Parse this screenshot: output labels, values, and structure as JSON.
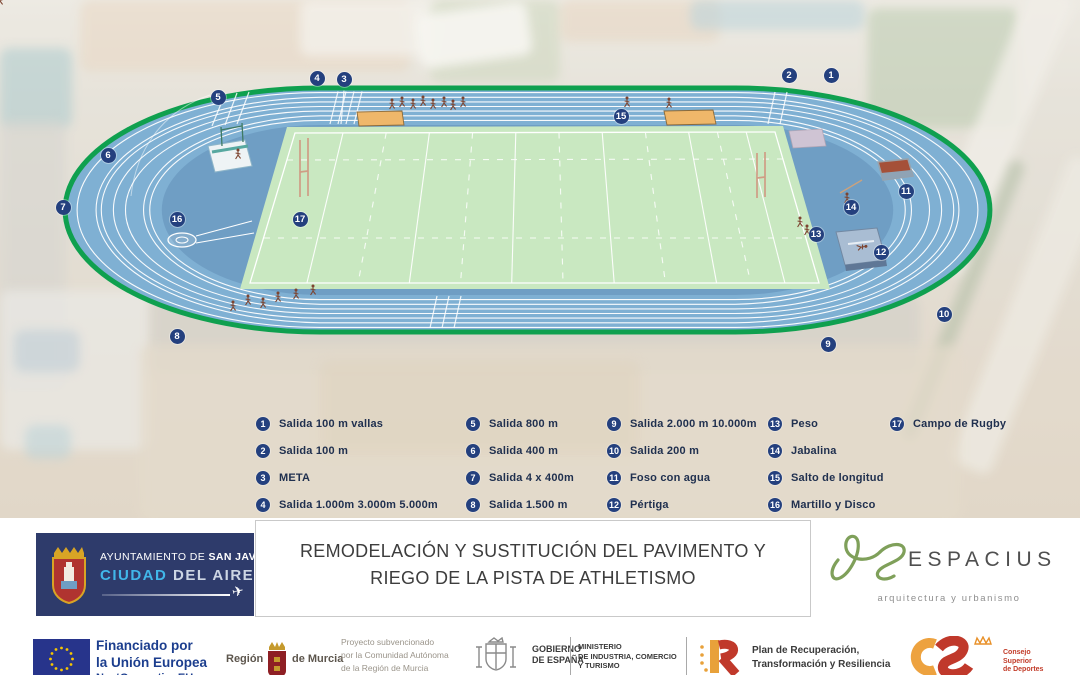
{
  "colors": {
    "marker_navy": "#24407e",
    "track_blue": "#7fb0d3",
    "infield_blue": "#6f9ec4",
    "field_green": "#c9e8c1",
    "edge_green": "#0fa04f",
    "eu_blue": "#27348b",
    "accent_cyan": "#41b7e9"
  },
  "markers": [
    {
      "n": "1",
      "x": 831,
      "y": 75
    },
    {
      "n": "2",
      "x": 789,
      "y": 75
    },
    {
      "n": "3",
      "x": 344,
      "y": 79
    },
    {
      "n": "4",
      "x": 317,
      "y": 78
    },
    {
      "n": "5",
      "x": 218,
      "y": 97
    },
    {
      "n": "6",
      "x": 108,
      "y": 155
    },
    {
      "n": "7",
      "x": 63,
      "y": 207
    },
    {
      "n": "8",
      "x": 177,
      "y": 336
    },
    {
      "n": "9",
      "x": 828,
      "y": 344
    },
    {
      "n": "10",
      "x": 944,
      "y": 314
    },
    {
      "n": "11",
      "x": 906,
      "y": 191
    },
    {
      "n": "12",
      "x": 881,
      "y": 252
    },
    {
      "n": "13",
      "x": 816,
      "y": 234
    },
    {
      "n": "14",
      "x": 851,
      "y": 207
    },
    {
      "n": "15",
      "x": 621,
      "y": 116
    },
    {
      "n": "16",
      "x": 177,
      "y": 219
    },
    {
      "n": "17",
      "x": 300,
      "y": 219
    }
  ],
  "legend": {
    "row_top": 417,
    "row_step": 27,
    "columns": [
      {
        "x": 256,
        "items": [
          {
            "n": "1",
            "label": "Salida 100 m vallas"
          },
          {
            "n": "2",
            "label": "Salida 100 m"
          },
          {
            "n": "3",
            "label": "META"
          },
          {
            "n": "4",
            "label": "Salida 1.000m 3.000m 5.000m"
          }
        ]
      },
      {
        "x": 466,
        "items": [
          {
            "n": "5",
            "label": "Salida 800 m"
          },
          {
            "n": "6",
            "label": "Salida 400 m"
          },
          {
            "n": "7",
            "label": "Salida 4 x 400m"
          },
          {
            "n": "8",
            "label": "Salida 1.500 m"
          }
        ]
      },
      {
        "x": 607,
        "items": [
          {
            "n": "9",
            "label": "Salida 2.000 m 10.000m"
          },
          {
            "n": "10",
            "label": "Salida 200 m"
          },
          {
            "n": "11",
            "label": "Foso con agua"
          },
          {
            "n": "12",
            "label": "Pértiga"
          }
        ]
      },
      {
        "x": 768,
        "items": [
          {
            "n": "13",
            "label": "Peso"
          },
          {
            "n": "14",
            "label": "Jabalina"
          },
          {
            "n": "15",
            "label": "Salto de longitud"
          },
          {
            "n": "16",
            "label": "Martillo y Disco"
          }
        ]
      },
      {
        "x": 890,
        "items": [
          {
            "n": "17",
            "label": "Campo de Rugby"
          }
        ]
      }
    ]
  },
  "footer": {
    "municipality": {
      "pre": "AYUNTAMIENTO DE ",
      "bold": "SAN JAVIER",
      "city_bold": "CIUDAD",
      "city_rest": " DEL AIRE"
    },
    "title": {
      "line1": "REMODELACIÓN Y SUSTITUCIÓN DEL PAVIMENTO Y",
      "line2": "RIEGO DE LA PISTA DE ATHLETISMO"
    },
    "studio": {
      "name": "ESPACIUS",
      "tagline": "arquitectura y urbanismo"
    },
    "eu": {
      "l1": "Financiado por",
      "l2": "la Unión Europea",
      "l3": "NextGenerationEU"
    },
    "murcia": {
      "left": "Región",
      "right": "de Murcia"
    },
    "subsidy": [
      "Proyecto subvencionado",
      "por la Comunidad Autónoma",
      "de la Región de Murcia"
    ],
    "gobierno": [
      "GOBIERNO",
      "DE ESPAÑA"
    ],
    "ministerio": [
      "MINISTERIO",
      "DE INDUSTRIA, COMERCIO",
      "Y TURISMO"
    ],
    "prtr": [
      "Plan de Recuperación,",
      "Transformación y Resiliencia"
    ],
    "csd": [
      "Consejo",
      "Superior",
      "de Deportes"
    ]
  }
}
